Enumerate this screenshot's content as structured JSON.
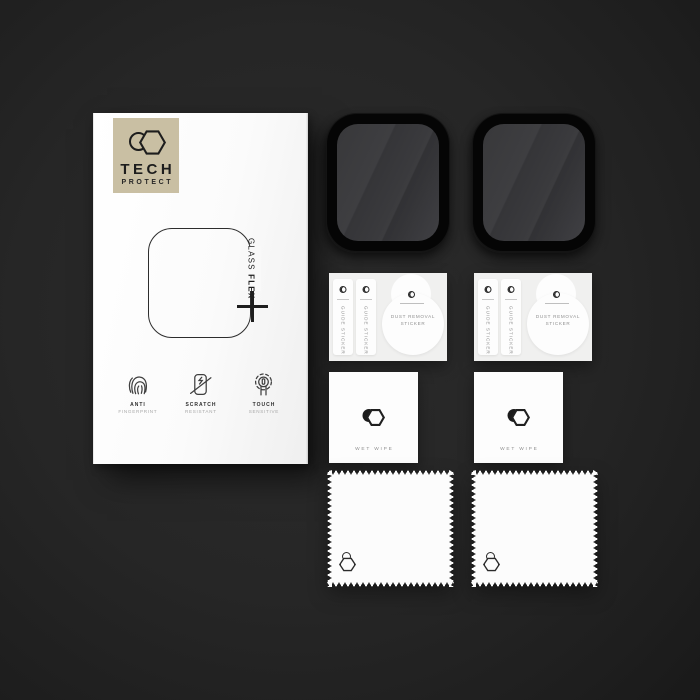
{
  "scene": {
    "description": "Product shot of smartwatch screen protector kit on dark background",
    "background_center_color": "#2c2c2c",
    "background_edge_color": "#161616"
  },
  "box": {
    "brand": {
      "name": "TECH",
      "sub": "PROTECT",
      "panel_color": "#c9bfa3",
      "mark_icon": "hexagon-circle-logo"
    },
    "product": {
      "line1": "GLASS",
      "line2": "FLEX"
    },
    "features": [
      {
        "icon": "fingerprint-icon",
        "title": "ANTI",
        "subtitle": "FINGERPRINT"
      },
      {
        "icon": "scratch-icon",
        "title": "SCRATCH",
        "subtitle": "RESISTANT"
      },
      {
        "icon": "touch-icon",
        "title": "TOUCH",
        "subtitle": "SENSITIVE"
      }
    ]
  },
  "accessories": {
    "screen_protector": {
      "count": 2,
      "bezel_color": "#050505",
      "glass_color": "#3a3a3c"
    },
    "sticker_card": {
      "count": 2,
      "card_color": "#f0f0ef",
      "guide_label": "GUIDE STICKER",
      "dust_label_line1": "DUST REMOVAL",
      "dust_label_line2": "STICKER"
    },
    "wet_wipe": {
      "count": 2,
      "label": "WET WIPE"
    },
    "cloth": {
      "count": 2
    }
  }
}
